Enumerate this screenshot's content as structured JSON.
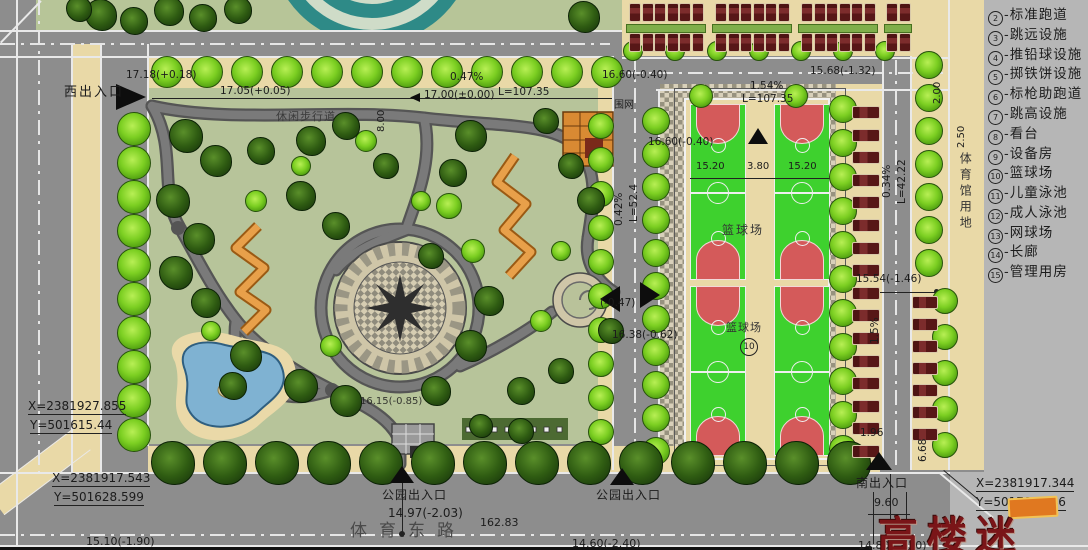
{
  "legend": {
    "separator": "-",
    "items": [
      {
        "num": "2",
        "label": "标准跑道"
      },
      {
        "num": "3",
        "label": "跳远设施"
      },
      {
        "num": "4",
        "label": "推铅球设施"
      },
      {
        "num": "5",
        "label": "掷铁饼设施"
      },
      {
        "num": "6",
        "label": "标枪助跑道"
      },
      {
        "num": "7",
        "label": "跳高设施"
      },
      {
        "num": "8",
        "label": "看台"
      },
      {
        "num": "9",
        "label": "设备房"
      },
      {
        "num": "10",
        "label": "篮球场"
      },
      {
        "num": "11",
        "label": "儿童泳池"
      },
      {
        "num": "12",
        "label": "成人泳池"
      },
      {
        "num": "13",
        "label": "网球场"
      },
      {
        "num": "14",
        "label": "长廊"
      },
      {
        "num": "15",
        "label": "管理用房"
      }
    ]
  },
  "entrances": {
    "west": "西出入口",
    "south": "南出入口",
    "park_1": "公园出入口",
    "park_2": "公园出入口"
  },
  "roads": {
    "name": "体育东路"
  },
  "areas": {
    "stadium_land": "体育馆用地",
    "basketball_1": "篮球场",
    "basketball_2": "篮球场",
    "basketball_ref_num": "10",
    "walkway": "休闲步行道",
    "fence": "围网"
  },
  "survey_points": {
    "west_top": {
      "x": "X=2381927.855",
      "y": "Y=501615.44"
    },
    "west_bottom": {
      "x": "X=2381917.543",
      "y": "Y=501628.599"
    },
    "south_east": {
      "x": "X=2381917.344",
      "y": "Y=501789.146"
    }
  },
  "dims": {
    "west_elev": "17.18(+0.18)",
    "elev_1705": "17.05(+0.05)",
    "elev_1700": "17.00(±0.00)",
    "slope_047": "0.47%",
    "len_107a": "L=107.35",
    "elev_1660_road": "16.60(-0.40)",
    "slope_154": "1.54%",
    "len_107b": "L=107.35",
    "elev_1568": "15.68(-1.32)",
    "dim_200": "2.00",
    "dim_250": "2.50",
    "dim_800": "8.00",
    "slope_042": "0.42%",
    "len_524": "L=52.4",
    "elev_1660_court": "16.60(-0.40)",
    "court_w_left": "15.20",
    "court_gap": "3.80",
    "court_w_right": "15.20",
    "slope_034": "0.34%",
    "len_4222": "L=42.22",
    "elev_047": "(-0.47)",
    "elev_1638": "16.38(-0.62)",
    "elev_1554": "15.54(-1.46)",
    "slope_15": "1.5%",
    "dim_196": "1.96",
    "dim_668": "6.68",
    "elev_1615": "16.15(-0.85)",
    "elev_1497": "14.97(-2.03)",
    "len_16283": "162.83",
    "elev_1510": "15.10(-1.90)",
    "elev_1460": "14.60(-2.40)",
    "dim_960": "9.60",
    "elev_1480": "14.80(-2.20)"
  },
  "watermark": {
    "text": "高楼迷"
  },
  "colors": {
    "road": "#8d8d8d",
    "sidewalk": "#e9d9a7",
    "park_green": "#b7c49a",
    "court_green": "#3ed12e",
    "court_red": "#d45a5a",
    "water": "#7fb2d2",
    "corridor_orange": "#e0913b",
    "track_teal": "#2e8a87",
    "tree_bright": "#76cc1e",
    "tree_dark": "#27520f",
    "car": "#571717",
    "legend_bg": "#b6b6b6",
    "watermark_red": "#7a1518"
  }
}
